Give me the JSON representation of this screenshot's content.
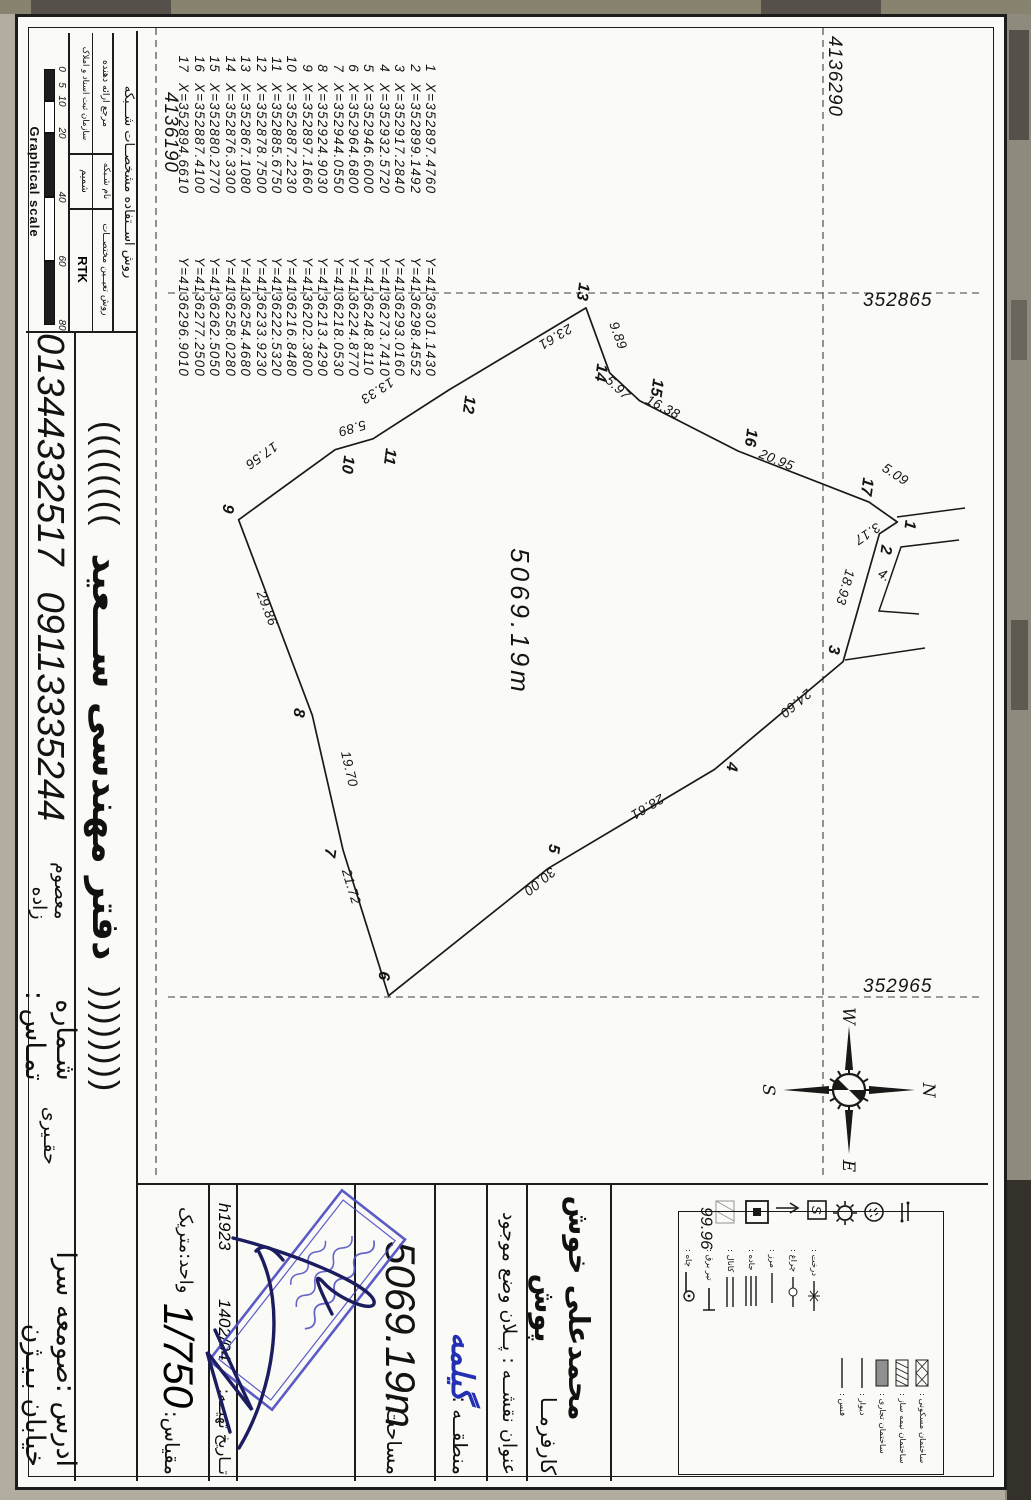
{
  "map": {
    "area_label": "5069.19m",
    "small_dim": "4",
    "grid": {
      "northing_top": "4136290",
      "northing_bottom": "4136190",
      "easting_left": "352865",
      "easting_right": "352965"
    },
    "compass": {
      "n": "N",
      "e": "E",
      "s": "S",
      "w": "W"
    },
    "vertices": [
      {
        "n": "1",
        "x": "352897.4760",
        "y": "4136301.1430"
      },
      {
        "n": "2",
        "x": "352899.1492",
        "y": "4136298.4552"
      },
      {
        "n": "3",
        "x": "352917.2840",
        "y": "4136293.0160"
      },
      {
        "n": "4",
        "x": "352932.5720",
        "y": "4136273.7410"
      },
      {
        "n": "5",
        "x": "352946.6000",
        "y": "4136248.8110"
      },
      {
        "n": "6",
        "x": "352964.6800",
        "y": "4136224.8770"
      },
      {
        "n": "7",
        "x": "352944.0550",
        "y": "4136218.0530"
      },
      {
        "n": "8",
        "x": "352924.9030",
        "y": "4136213.4290"
      },
      {
        "n": "9",
        "x": "352897.1660",
        "y": "4136202.3800"
      },
      {
        "n": "10",
        "x": "352887.2230",
        "y": "4136216.8480"
      },
      {
        "n": "11",
        "x": "352885.6750",
        "y": "4136222.5320"
      },
      {
        "n": "12",
        "x": "352878.7500",
        "y": "4136233.9230"
      },
      {
        "n": "13",
        "x": "352867.1080",
        "y": "4136254.4680"
      },
      {
        "n": "14",
        "x": "352876.3300",
        "y": "4136258.0280"
      },
      {
        "n": "15",
        "x": "352880.2770",
        "y": "4136262.5050"
      },
      {
        "n": "16",
        "x": "352887.4100",
        "y": "4136277.2500"
      },
      {
        "n": "17",
        "x": "352894.6610",
        "y": "4136296.9010"
      }
    ],
    "edge_lengths": [
      "3.17",
      "18.93",
      "24.60",
      "28.61",
      "30.00",
      "21.72",
      "19.70",
      "29.86",
      "17.56",
      "5.89",
      "13.33",
      "23.61",
      "9.89",
      "5.97",
      "16.38",
      "20.95",
      "5.09"
    ]
  },
  "network_table": {
    "header": "روش اســتفاده مشخصــات شـــبکه",
    "columns": [
      {
        "label": "روش تعیــین مختصــات",
        "value": "RTK"
      },
      {
        "label": "نام شـبکه",
        "value": "شمیم"
      },
      {
        "label": "مرجع ارائه دهنده",
        "value": "سازمان ثبت اسناد و املاک"
      }
    ]
  },
  "graphical_scale": {
    "label": "Graphical scale",
    "ticks": [
      "0",
      "5",
      "10",
      "20",
      "40",
      "60",
      "80"
    ]
  },
  "title_block": {
    "legend_value": "99.96",
    "client_label": "کارفرمــا",
    "client_name": "محمدعلی خوش پوش",
    "map_title": "عنوان نقشــه : پــلان وضع موجود",
    "region_label": "منطقــه :",
    "region_value": "گیلمه",
    "area_label": "مساحت :",
    "area_value": "5069.19m",
    "date_label": "تــاریخ تهیــه:",
    "date_value": "1402/04",
    "code": "h1923",
    "scale_label": "مقیاس:",
    "scale_value": "1/750",
    "unit_label": "واحد:متریک"
  },
  "legend": {
    "right_items": [
      {
        "label": "ساختمان مسکونی :",
        "sym": "box-crosshatch"
      },
      {
        "label": "ساختمان نیمه ساز :",
        "sym": "box-hatch"
      },
      {
        "label": "ساختمان تجاری :",
        "sym": "box-gray"
      },
      {
        "label": "دیوار :",
        "sym": "line"
      },
      {
        "label": "فنس :",
        "sym": "line"
      }
    ],
    "left_items": [
      {
        "label": "درخت :",
        "sym": "line-star"
      },
      {
        "label": "چراغ :",
        "sym": "line-circle"
      },
      {
        "label": "مرز :",
        "sym": "line"
      },
      {
        "label": "جاده :",
        "sym": "line3"
      },
      {
        "label": "کانال :",
        "sym": "line2"
      },
      {
        "label": "تیر برق :",
        "sym": "line-T"
      },
      {
        "label": "چاه :",
        "sym": "line-endcircle"
      }
    ]
  },
  "footer": {
    "paren_left": "((((((((",
    "office_name": "دفتر مهندسی ســـعید",
    "paren_right": "))))))))",
    "address": "ادرس :صومعه سرا خیابان بـیـژن",
    "name_small_1": "حقـیری",
    "phone_label": "شـماره تمـاس :",
    "name_small_2": "معصوم زاده",
    "phone_1": "09113335244",
    "phone_2": "01344332517"
  }
}
